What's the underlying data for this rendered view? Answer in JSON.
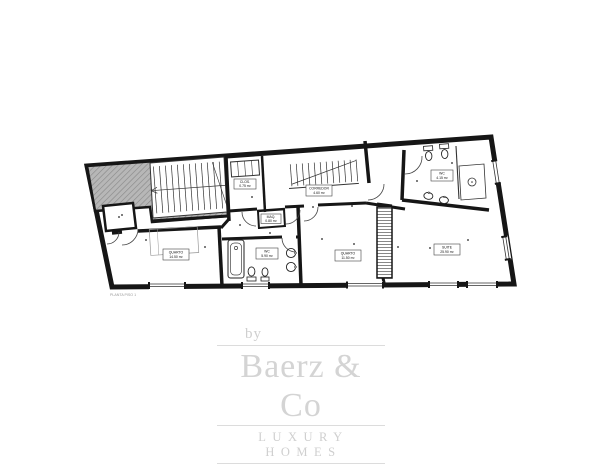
{
  "plan": {
    "caption": "PLANTA PISO 1",
    "rooms": [
      {
        "name": "QUARTO",
        "area": "14.50 m²"
      },
      {
        "name": "WC",
        "area": "5.90 m²"
      },
      {
        "name": "MAQ.",
        "area": "0.80 m²"
      },
      {
        "name": "QUARTO",
        "area": "11.50 m²"
      },
      {
        "name": "SUITE",
        "area": "25.90 m²"
      },
      {
        "name": "WC",
        "area": "4.15 m²"
      },
      {
        "name": "CORREDOR",
        "area": "4.60 m²"
      },
      {
        "name": "CLOS.",
        "area": "0.75 m²"
      }
    ],
    "colors": {
      "wall": "#161616",
      "stair_fill": "#b7b7b7",
      "hatch": "#878787",
      "caption": "#9a9a9a"
    }
  },
  "logo": {
    "by": "by",
    "brand": "Baerz & Co",
    "tagline": "LUXURY HOMES",
    "color": "#d2d2d2"
  }
}
